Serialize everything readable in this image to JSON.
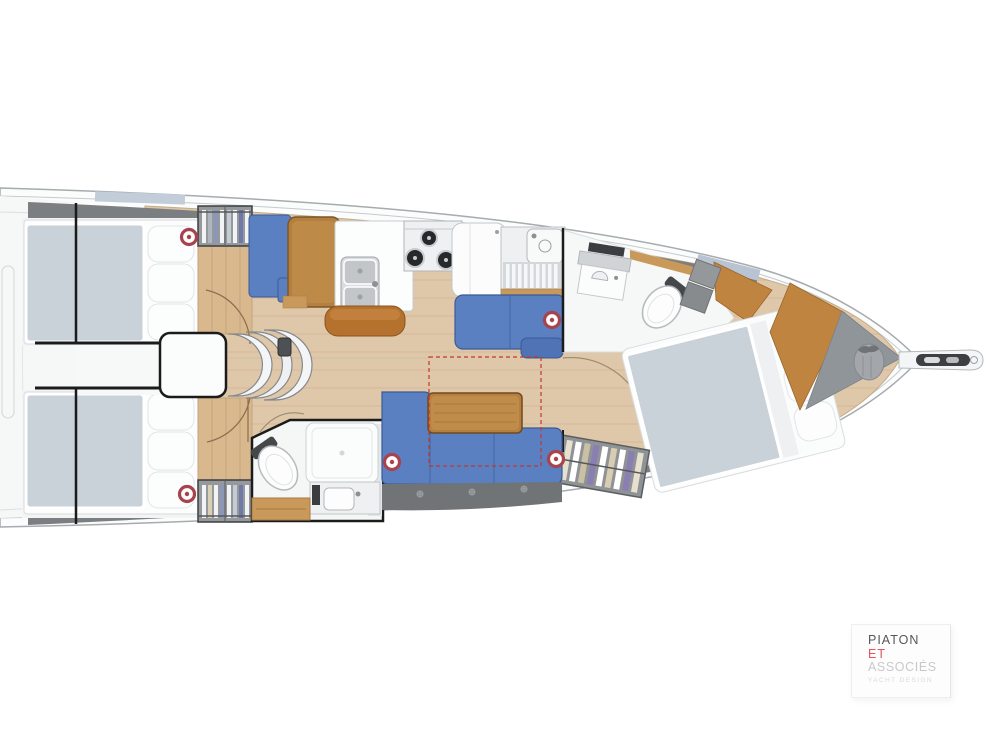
{
  "page": {
    "width": 993,
    "height": 745,
    "background": "#ffffff"
  },
  "logo": {
    "line1": "PIATON",
    "line2": "ET",
    "line3": "ASSOCIÉS",
    "subtitle": "YACHT DESIGN"
  },
  "colors": {
    "hull_fill": "#fbfcfc",
    "hull_line": "#a6abaf",
    "deck_band": "#7b7f82",
    "window_tint": "#bcc7d6",
    "floor_wood": "#dfc8a9",
    "plank_line": "#9b7344",
    "table_wood": "#b5803f",
    "table_top": "#c08c4a",
    "trim_wood": "#c9995c",
    "bulkhead_wood": "#c08441",
    "leather_brown": "#b5712e",
    "settee_blue": "#5b80c1",
    "settee_edge": "#3a5a97",
    "mattress": "#c9d1d9",
    "linen_white": "#fcfdfd",
    "locker_gray": "#707477",
    "cabinet_gray": "#92969a",
    "wall_black": "#1b1b1b",
    "speaker_red": "#a8424c",
    "dashed_red": "#c4372f",
    "logo_line1": "#56575a",
    "logo_line2": "#e2555f",
    "logo_line3": "#c8c9cb",
    "logo_subtitle": "#d9dadc"
  },
  "plan": {
    "type": "sailboat-interior-floor-plan",
    "stove_burners": 3,
    "speakers": [
      {
        "t": "translate(189,237)"
      },
      {
        "t": "translate(552,320)"
      },
      {
        "t": "translate(392,462)"
      },
      {
        "t": "translate(556,459)"
      },
      {
        "t": "translate(187,494)"
      }
    ],
    "regions": [
      "aft-port-cabin",
      "aft-starboard-cabin",
      "companionway",
      "nav-station",
      "galley",
      "port-settee",
      "aft-head",
      "saloon-dinette",
      "forward-head",
      "bow-cabin",
      "anchor-locker",
      "bowsprit"
    ]
  }
}
